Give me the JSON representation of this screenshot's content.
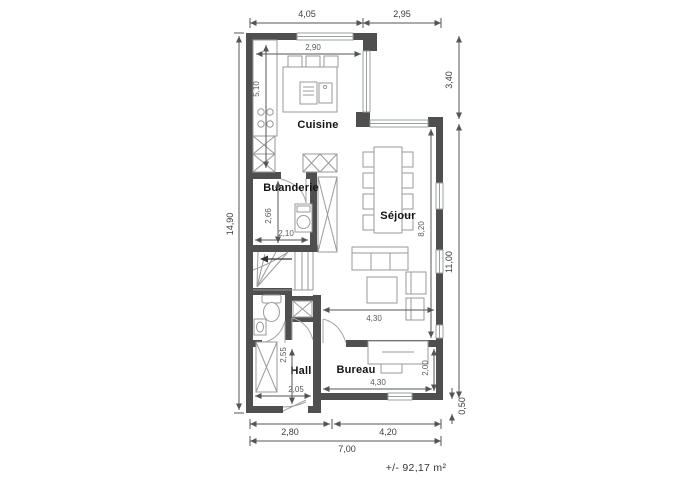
{
  "floorplan": {
    "area_label": "+/- 92,17 m²",
    "rooms": {
      "cuisine": "Cuisine",
      "buanderie": "Buanderie",
      "sejour": "Séjour",
      "hall": "Hall",
      "bureau": "Bureau"
    },
    "dims_exterior": {
      "top_left": "4,05",
      "top_right": "2,95",
      "right_upper": "3,40",
      "right_main": "11,00",
      "right_lower": "0,50",
      "left": "14,90",
      "bottom_left": "2,80",
      "bottom_right": "4,20",
      "bottom_total": "7,00"
    },
    "dims_interior": {
      "cuisine_w": "2,90",
      "cuisine_h": "5,10",
      "buanderie_h": "2,66",
      "buanderie_w": "2,10",
      "sejour_h": "8,20",
      "sejour_w": "4,30",
      "hall_h": "2,55",
      "hall_w": "2,05",
      "bureau_w": "4,30",
      "bureau_h": "2,00"
    },
    "colors": {
      "wall": "#4f4f4f",
      "window": "#9aa0a6",
      "furniture": "#9a9a9a",
      "dim_line": "#555555",
      "dim_text": "#3c3c3c",
      "label_text": "#141414",
      "background": "#ffffff"
    }
  }
}
